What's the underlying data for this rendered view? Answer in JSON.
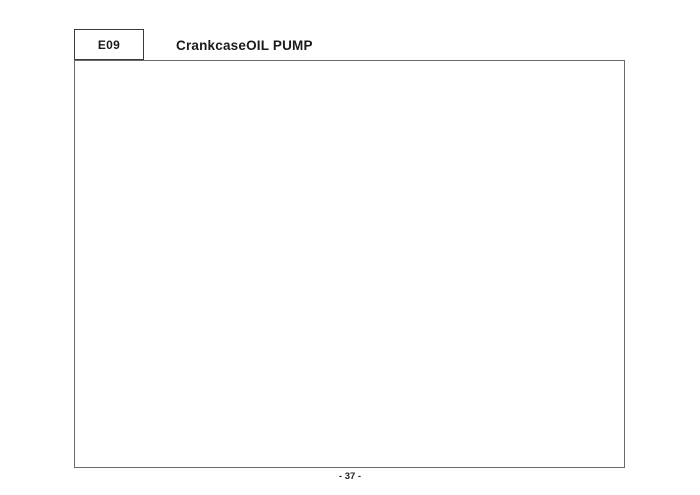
{
  "header": {
    "code": "E09",
    "title": "CrankcaseOIL PUMP"
  },
  "footer": {
    "page_number": "- 37 -"
  },
  "watermark": {
    "text": "KYMCO"
  },
  "colors": {
    "line": "#1a1a1a",
    "frame_border": "#6a6a6a",
    "label_text": "#111111",
    "background": "#ffffff"
  },
  "diagram": {
    "description": "Exploded parts view of crankcase and oil pump",
    "group_label": "11200",
    "labels": [
      {
        "id": "90120",
        "text": "90120",
        "x": 333,
        "y": 104
      },
      {
        "id": "96001-06028",
        "text": "96001-06028",
        "x": 300,
        "y": 114
      },
      {
        "id": "91304",
        "text": "91304",
        "x": 399,
        "y": 122
      },
      {
        "id": "1621a",
        "text": "1621A",
        "x": 444,
        "y": 116
      },
      {
        "id": "96001-06045",
        "text": "96001-06045",
        "x": 214,
        "y": 113
      },
      {
        "id": "96001-06060",
        "text": "96001-06060",
        "x": 150,
        "y": 127
      },
      {
        "id": "96001-06075",
        "text": "96001-06075",
        "x": 111,
        "y": 146
      },
      {
        "id": "94001",
        "text": "94001",
        "x": 209,
        "y": 170
      },
      {
        "id": "90001-gbhb-751",
        "text": "90001-GBHB-751",
        "x": 85,
        "y": 183
      },
      {
        "id": "91201",
        "text": "91201",
        "x": 159,
        "y": 209
      },
      {
        "id": "91005-left",
        "text": "91005",
        "x": 139,
        "y": 230
      },
      {
        "id": "11102-left",
        "text": "11102",
        "x": 160,
        "y": 240
      },
      {
        "id": "1110a",
        "text": "1110A",
        "x": 167,
        "y": 258
      },
      {
        "id": "95002-top",
        "text": "95002",
        "x": 299,
        "y": 174
      },
      {
        "id": "1552a",
        "text": "1552A",
        "x": 284,
        "y": 196
      },
      {
        "id": "17100",
        "text": "17100",
        "x": 371,
        "y": 150
      },
      {
        "id": "17111",
        "text": "17111",
        "x": 370,
        "y": 163
      },
      {
        "id": "14100",
        "text": "14100",
        "x": 367,
        "y": 180
      },
      {
        "id": "17112",
        "text": "17112",
        "x": 361,
        "y": 204
      },
      {
        "id": "11203",
        "text": "11203",
        "x": 402,
        "y": 153
      },
      {
        "id": "11206",
        "text": "11206",
        "x": 498,
        "y": 182
      },
      {
        "id": "91005-right",
        "text": "91005",
        "x": 451,
        "y": 229
      },
      {
        "id": "11200",
        "text": "11200",
        "x": 531,
        "y": 264
      },
      {
        "id": "91202-knbn-92a",
        "text": "91202-KNBN-92A",
        "x": 452,
        "y": 277
      },
      {
        "id": "91202-knbn-92b",
        "text": "91202-KNBN-92B",
        "x": 452,
        "y": 287
      },
      {
        "id": "96100-62033",
        "text": "96100-62033",
        "x": 405,
        "y": 288
      },
      {
        "id": "96100-62023",
        "text": "96100-62023",
        "x": 386,
        "y": 321
      },
      {
        "id": "11205",
        "text": "11205",
        "x": 360,
        "y": 315
      },
      {
        "id": "11102-bottom",
        "text": "11102",
        "x": 358,
        "y": 325
      },
      {
        "id": "91204",
        "text": "91204",
        "x": 360,
        "y": 336
      },
      {
        "id": "93500",
        "text": "93500",
        "x": 264,
        "y": 339
      },
      {
        "id": "11208",
        "text": "11208",
        "x": 317,
        "y": 363
      },
      {
        "id": "96001-06032",
        "text": "96001-06032",
        "x": 102,
        "y": 276
      },
      {
        "id": "15110",
        "text": "15110",
        "x": 149,
        "y": 294
      },
      {
        "id": "32906",
        "text": "32906",
        "x": 136,
        "y": 311
      },
      {
        "id": "15100",
        "text": "15100",
        "x": 215,
        "y": 305
      },
      {
        "id": "90201",
        "text": "90201",
        "x": 236,
        "y": 312
      },
      {
        "id": "94301-top",
        "text": "94301",
        "x": 282,
        "y": 224
      },
      {
        "id": "94301-bottom",
        "text": "94301",
        "x": 257,
        "y": 284
      },
      {
        "id": "95002-bottom",
        "text": "95002",
        "x": 253,
        "y": 263
      },
      {
        "id": "90001-gbhb-711",
        "text": "90001-GBHB-711",
        "x": 556,
        "y": 306
      },
      {
        "id": "95801",
        "text": "95801",
        "x": 546,
        "y": 323
      },
      {
        "id": "96001-06040",
        "text": "96001-06040",
        "x": 532,
        "y": 339
      }
    ]
  }
}
